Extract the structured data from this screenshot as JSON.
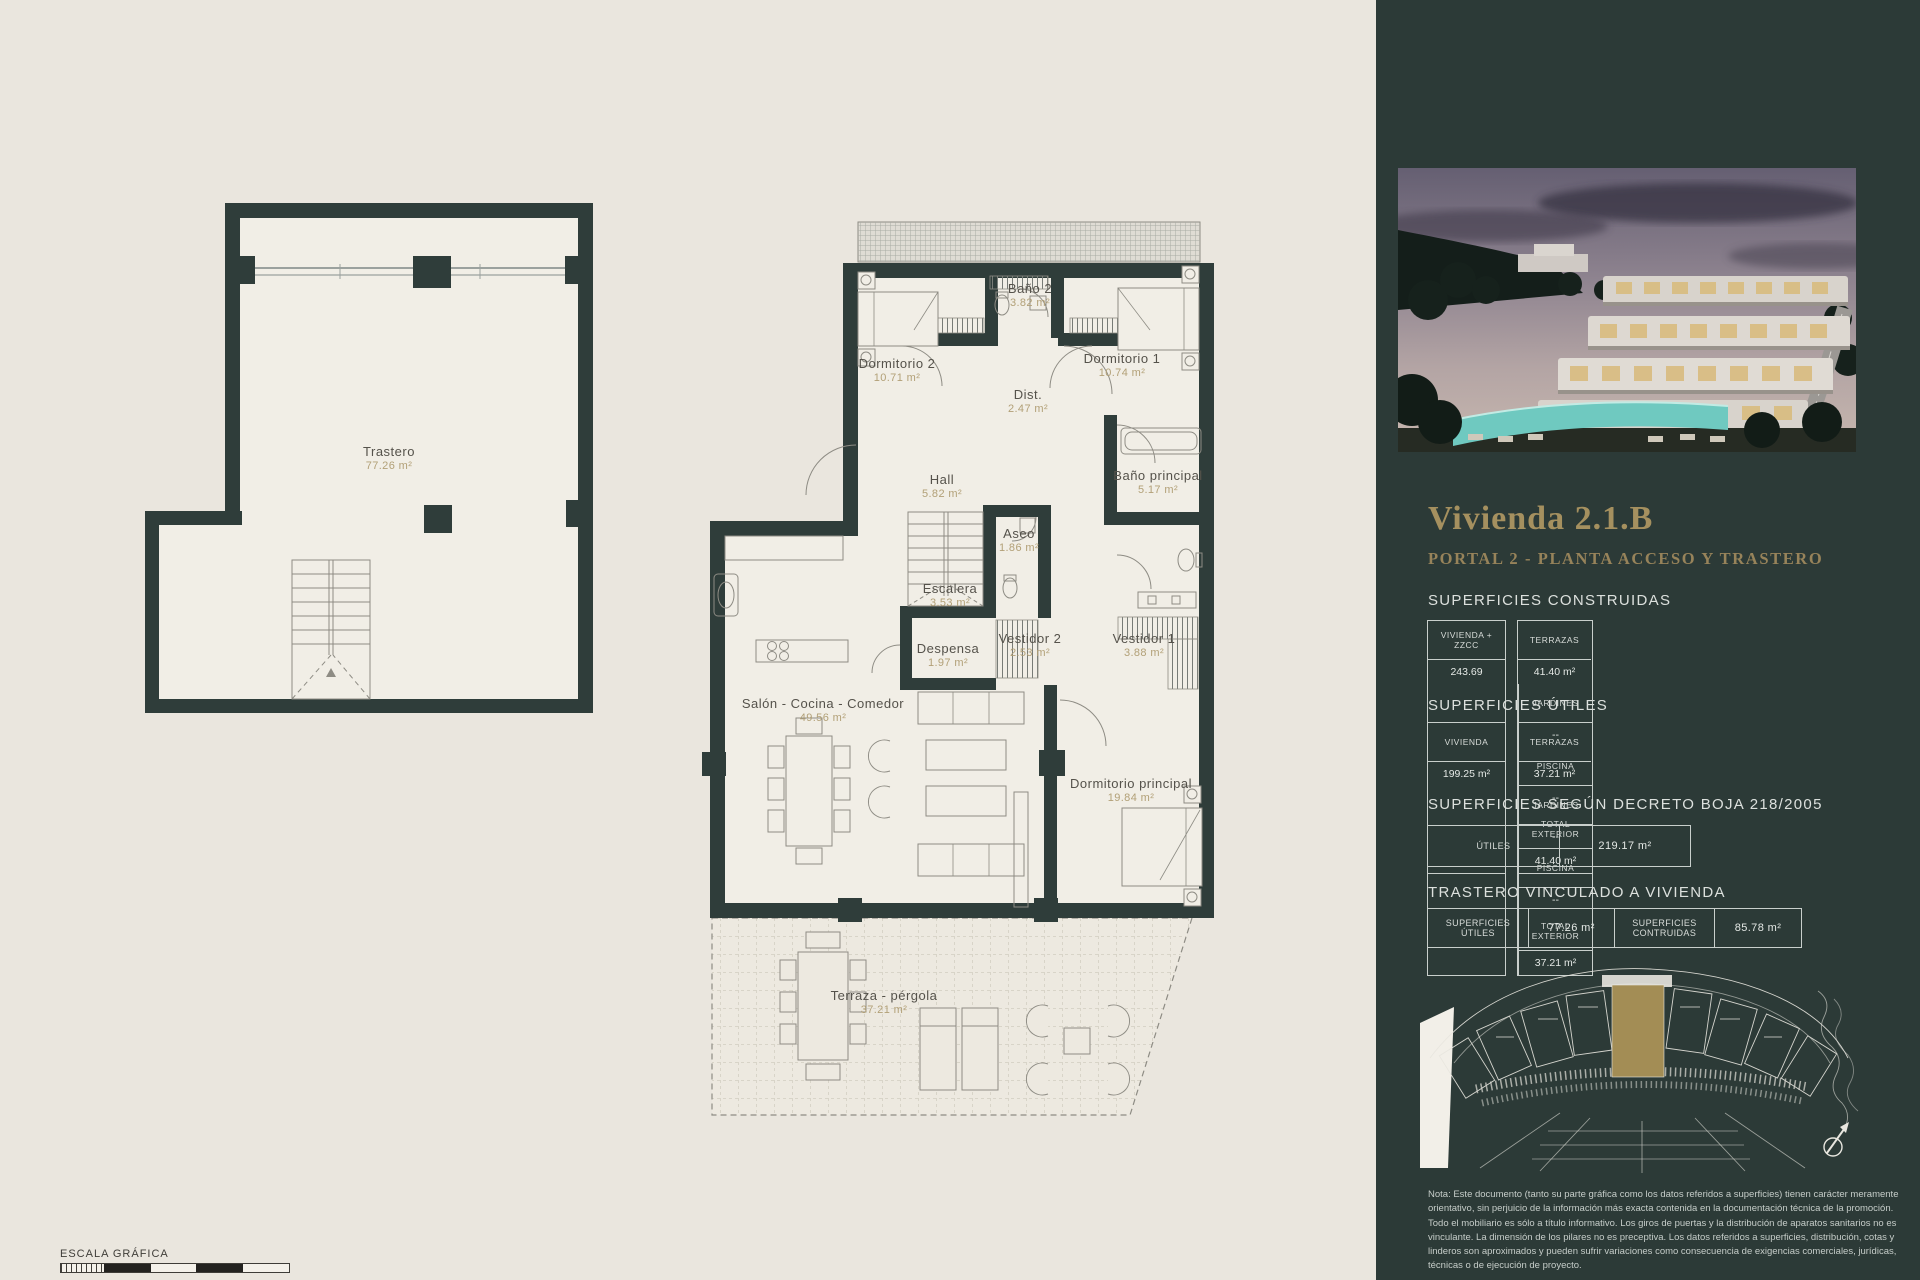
{
  "colors": {
    "page_bg": "#EAE6DE",
    "sidebar_bg": "#2C3A37",
    "wall": "#2F3D3A",
    "accent_gold": "#A5905F",
    "area_text": "#B2A077",
    "highlight_unit": "#A38D55"
  },
  "icons": {
    "compass": "↗"
  },
  "scale_bar": {
    "label": "ESCALA GRÁFICA"
  },
  "plans": {
    "trastero": {
      "room": {
        "name": "Trastero",
        "area": "77.26 m²"
      }
    },
    "main": {
      "rooms": [
        {
          "name": "Dormitorio 2",
          "area": "10.71 m²"
        },
        {
          "name": "Baño 2",
          "area": "3.82 m²"
        },
        {
          "name": "Dormitorio 1",
          "area": "10.74 m²"
        },
        {
          "name": "Dist.",
          "area": "2.47 m²"
        },
        {
          "name": "Hall",
          "area": "5.82 m²"
        },
        {
          "name": "Baño principal",
          "area": "5.17 m²"
        },
        {
          "name": "Aseo",
          "area": "1.86 m²"
        },
        {
          "name": "Escalera",
          "area": "3.53 m²"
        },
        {
          "name": "Vestidor 2",
          "area": "2.53 m²"
        },
        {
          "name": "Vestidor 1",
          "area": "3.88 m²"
        },
        {
          "name": "Despensa",
          "area": "1.97 m²"
        },
        {
          "name": "Salón - Cocina - Comedor",
          "area": "49.56 m²"
        },
        {
          "name": "Dormitorio principal",
          "area": "19.84 m²"
        },
        {
          "name": "Terraza - pérgola",
          "area": "37.21 m²"
        }
      ]
    }
  },
  "sidebar": {
    "title": "Vivienda 2.1.B",
    "subtitle": "PORTAL 2 - PLANTA ACCESO Y TRASTERO",
    "construidas": {
      "heading": "SUPERFICIES CONSTRUIDAS",
      "left": {
        "header": "VIVIENDA + ZZCC",
        "value": "243.69"
      },
      "cols": [
        {
          "header": "TERRAZAS",
          "value": "41.40 m²"
        },
        {
          "header": "JARDINES",
          "value": "--"
        },
        {
          "header": "PISCINA",
          "value": "--"
        },
        {
          "header": "TOTAL EXTERIOR",
          "value": "41.40 m²"
        }
      ]
    },
    "utiles": {
      "heading": "SUPERFICIES ÚTILES",
      "left": {
        "header": "VIVIENDA",
        "value": "199.25 m²"
      },
      "cols": [
        {
          "header": "TERRAZAS",
          "value": "37.21 m²"
        },
        {
          "header": "JARDINES",
          "value": "--"
        },
        {
          "header": "PISCINA",
          "value": "--"
        },
        {
          "header": "TOTAL EXTERIOR",
          "value": "37.21 m²"
        }
      ]
    },
    "decreto": {
      "heading": "SUPERFICIES SEGÚN DECRETO BOJA 218/2005",
      "cells": [
        {
          "label": "ÚTILES",
          "value": "219.17 m²"
        }
      ]
    },
    "trastero_vinculado": {
      "heading": "TRASTERO VINCULADO A VIVIENDA",
      "cells": [
        {
          "label": "SUPERFICIES ÚTILES",
          "value": "77.26 m²"
        },
        {
          "label": "SUPERFICIES CONTRUIDAS",
          "value": "85.78 m²"
        }
      ]
    },
    "note": "Nota: Este documento (tanto su parte gráfica como los datos referidos a superficies) tienen carácter meramente orientativo, sin perjuicio de la información más exacta contenida en la documentación técnica de la promoción. Todo el mobiliario es sólo a título informativo. Los giros de puertas y la distribución de aparatos sanitarios no es vinculante. La dimensión de los pilares no es preceptiva. Los datos referidos a superficies, distribución, cotas y linderos son aproximados y pueden sufrir variaciones como consecuencia de exigencias comerciales, jurídicas, técnicas o de ejecución de proyecto."
  }
}
